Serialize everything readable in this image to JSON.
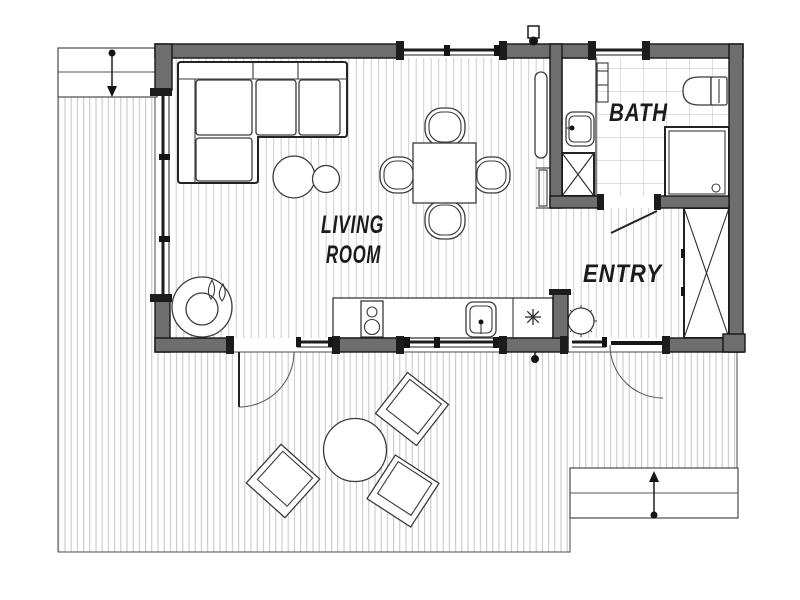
{
  "floorplan": {
    "labels": {
      "living_room_line1": "LIVING",
      "living_room_line2": "ROOM",
      "bath": "BATH",
      "entry": "ENTRY"
    },
    "colors": {
      "wall-fill": "#6e6e6e",
      "wall-stroke": "#161616",
      "floor-hatch": "#cccccc",
      "deck-hatch": "#c3c3c3",
      "tile-grid": "#bdbdbd",
      "furniture-stroke": "#3a3a3a",
      "thin-line": "#555555",
      "label-text": "#1b1b1b"
    },
    "icons": {
      "stove_flames": "flame-icon",
      "kitchen_light": "asterisk-light-icon",
      "deck_stair_arrows": "direction-arrow-icon"
    }
  }
}
